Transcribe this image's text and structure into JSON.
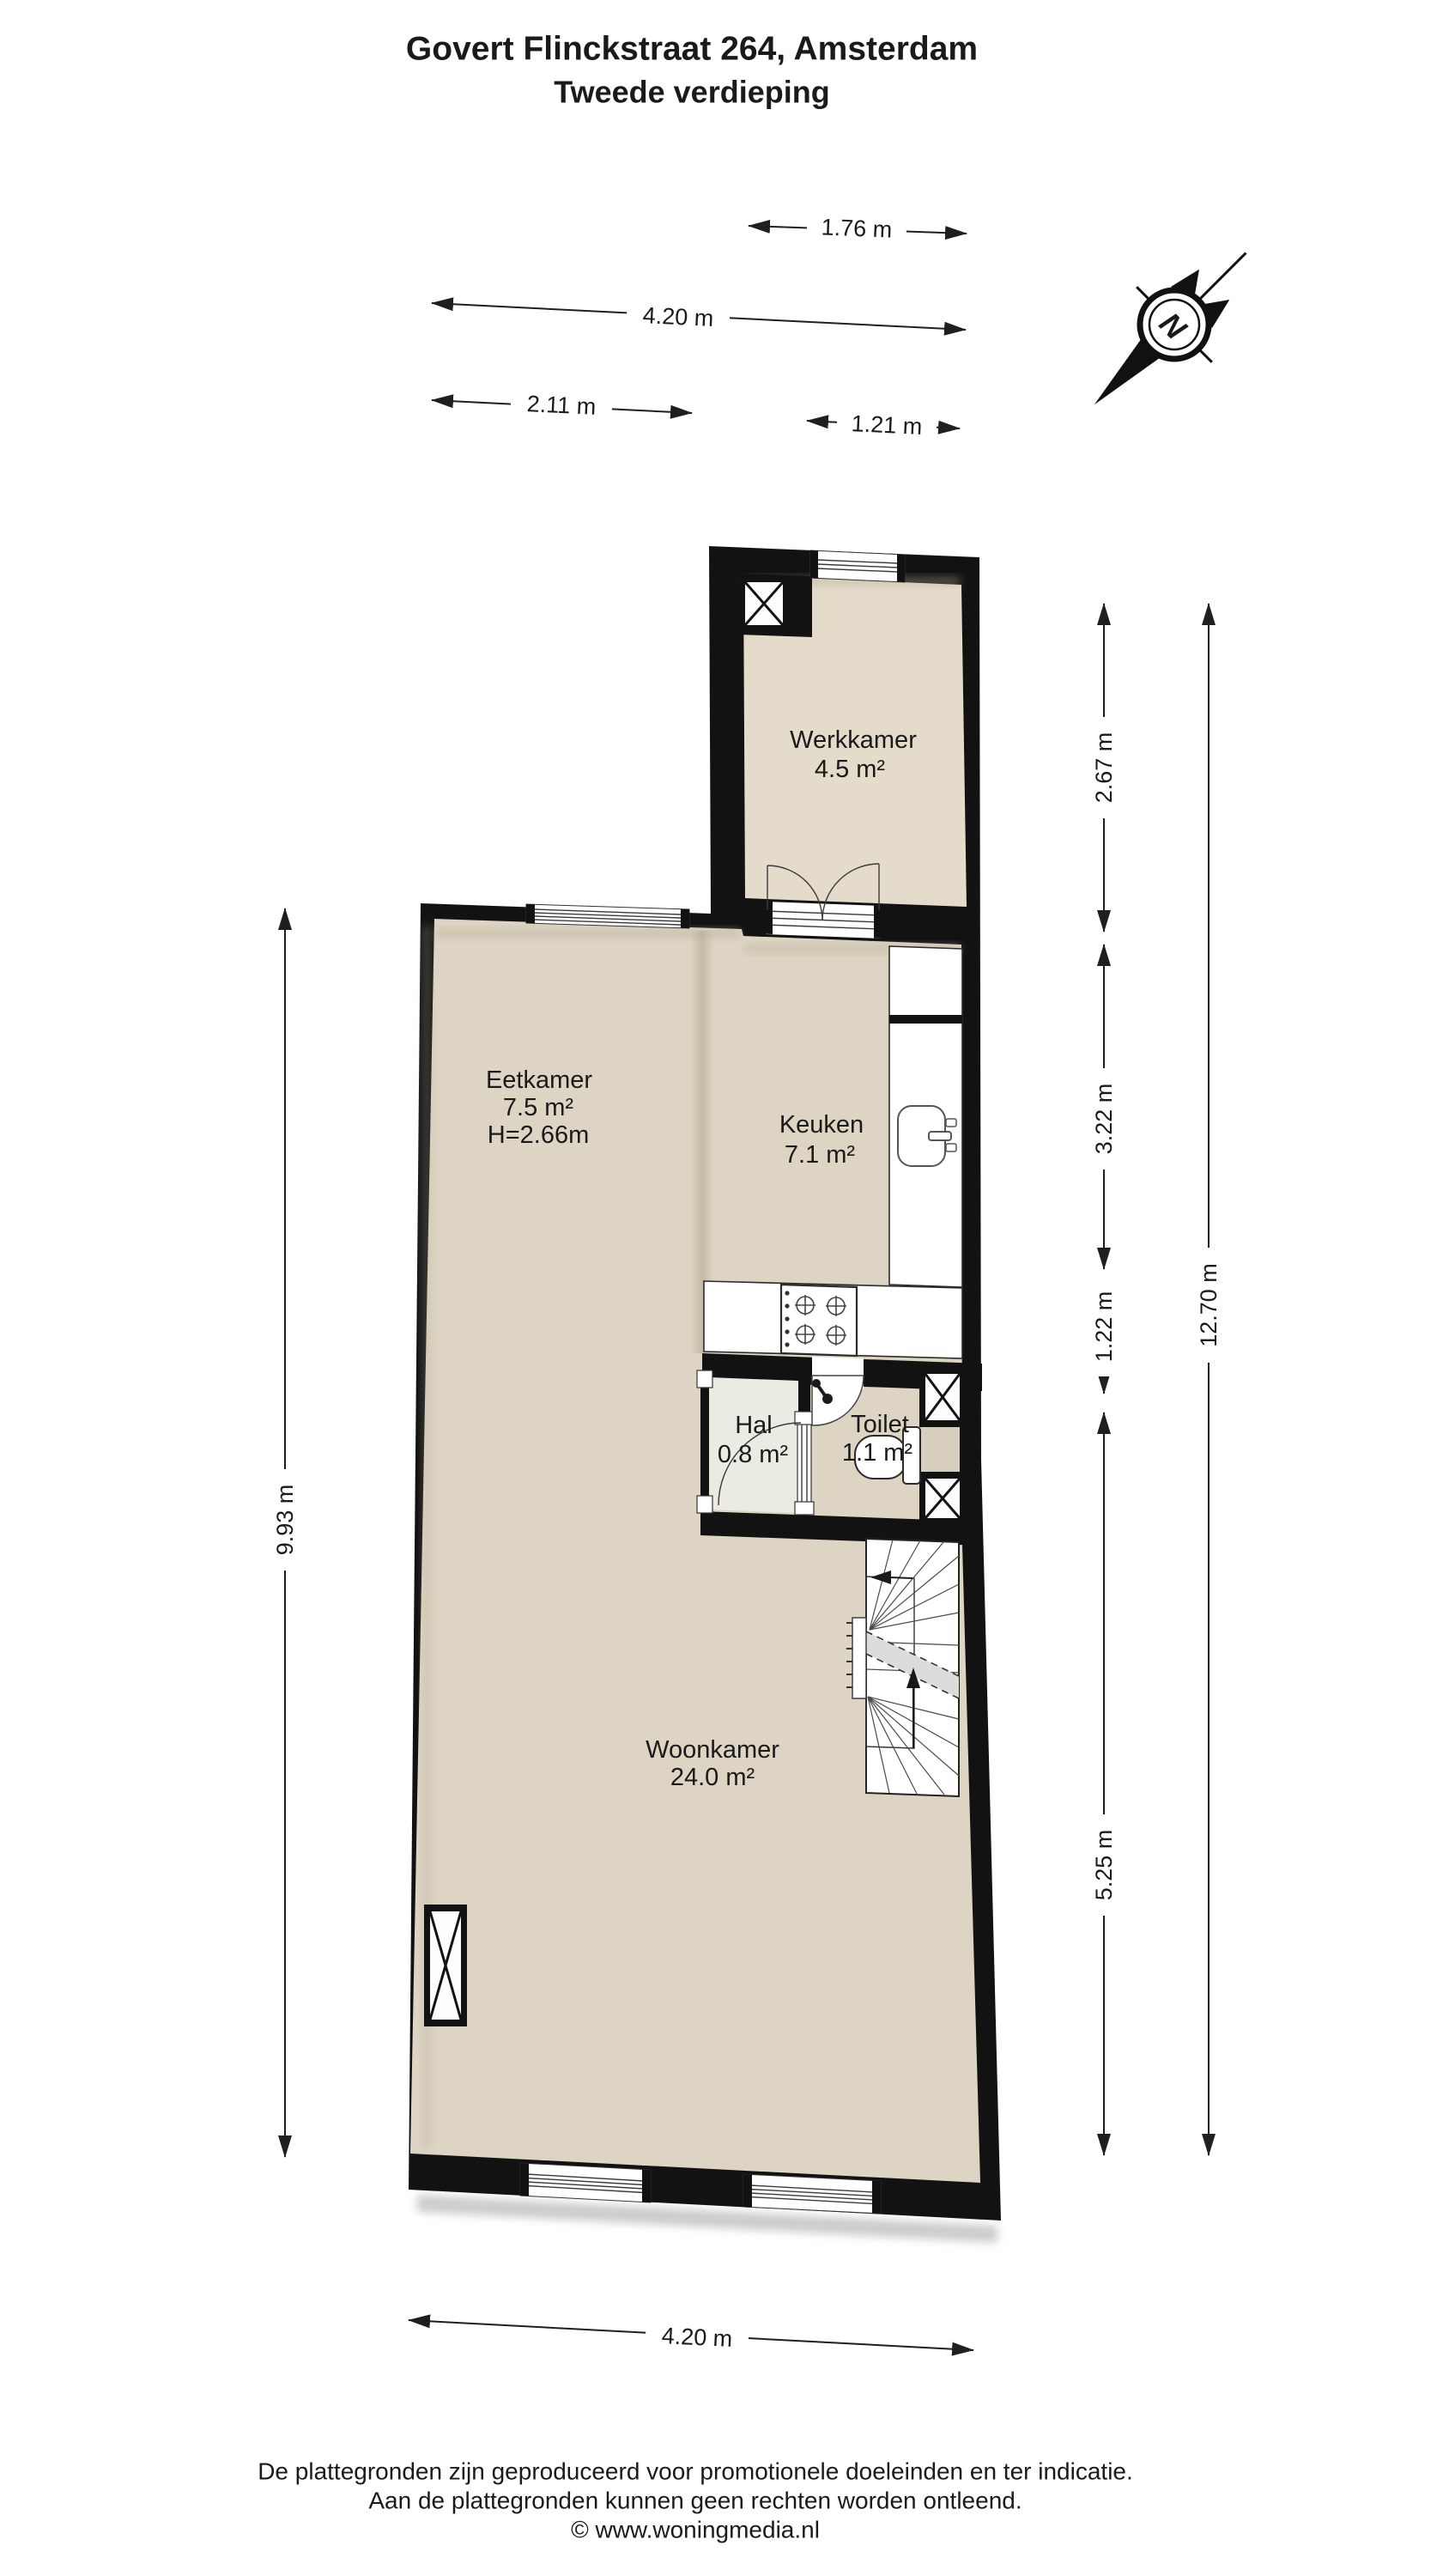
{
  "title": {
    "line1": "Govert Flinckstraat 264, Amsterdam",
    "line2": "Tweede verdieping"
  },
  "rooms": {
    "werkkamer": {
      "name": "Werkkamer",
      "area": "4.5 m²"
    },
    "eetkamer": {
      "name": "Eetkamer",
      "area": "7.5 m²",
      "height": "H=2.66m"
    },
    "keuken": {
      "name": "Keuken",
      "area": "7.1 m²"
    },
    "hal": {
      "name": "Hal",
      "area": "0.8 m²"
    },
    "toilet": {
      "name": "Toilet",
      "area": "1.1 m²"
    },
    "woonkamer": {
      "name": "Woonkamer",
      "area": "24.0 m²"
    }
  },
  "dims": {
    "top_176": {
      "label": "1.76 m"
    },
    "top_420": {
      "label": "4.20 m"
    },
    "top_211": {
      "label": "2.11 m"
    },
    "top_121": {
      "label": "1.21 m"
    },
    "right_267": {
      "label": "2.67 m"
    },
    "right_322": {
      "label": "3.22 m"
    },
    "right_122": {
      "label": "1.22 m"
    },
    "right_525": {
      "label": "5.25 m"
    },
    "right_1270": {
      "label": "12.70 m"
    },
    "left_993": {
      "label": "9.93 m"
    },
    "bottom_420": {
      "label": "4.20 m"
    }
  },
  "compass": {
    "label": "N"
  },
  "footer": {
    "line1": "De plattegronden zijn geproduceerd voor promotionele doeleinden en ter indicatie.",
    "line2": "Aan de plattegronden kunnen geen rechten worden ontleend.",
    "line3": "© www.woningmedia.nl"
  },
  "colors": {
    "wall": "#121212",
    "floor_main": "#ddd4c3",
    "floor_wing": "#e4dbcb",
    "floor_toilet": "#d8cec0",
    "floor_hal": "#ebebe4",
    "stairs": "#ffffff"
  }
}
